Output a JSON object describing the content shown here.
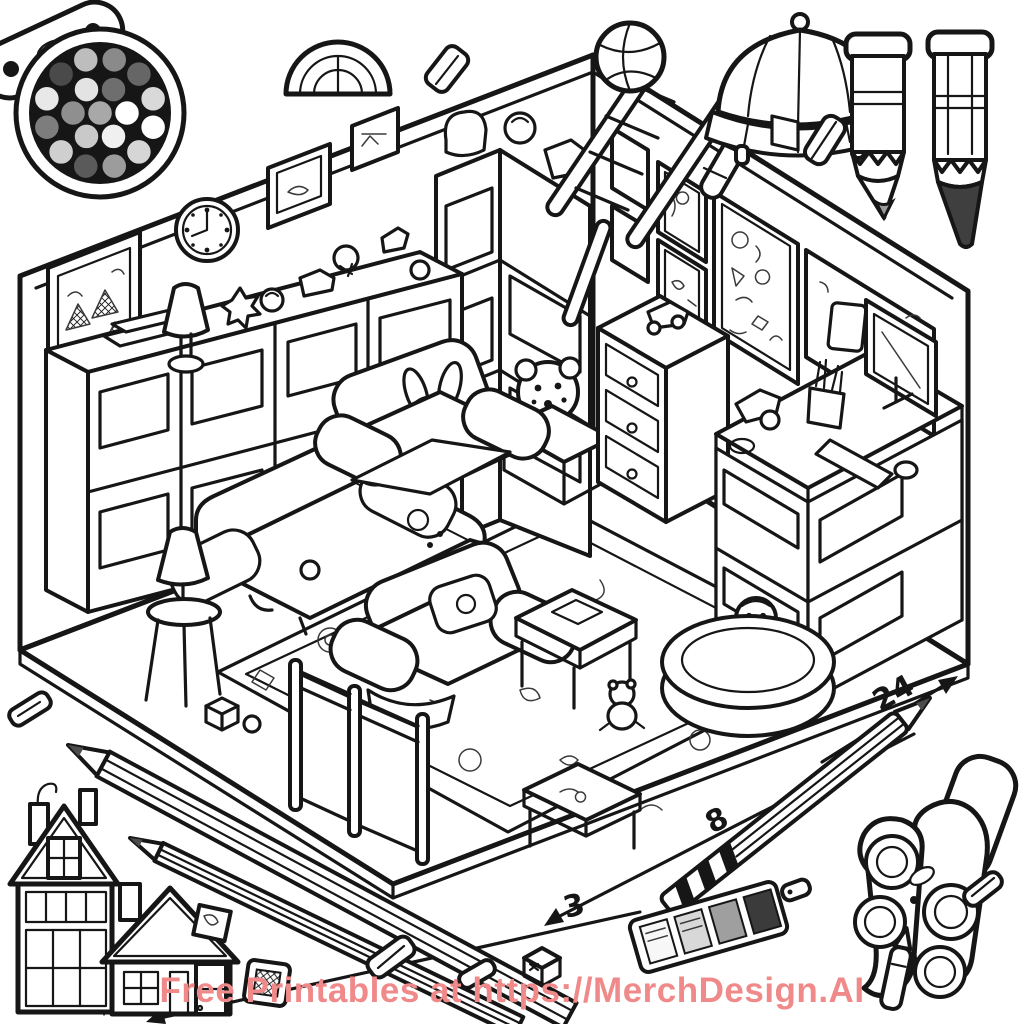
{
  "artwork": {
    "title": "Isometric playroom coloring page",
    "ink_color": "#161616",
    "background_color": "#ffffff"
  },
  "watermark": {
    "text": "Free Printables at https://MerchDesign.AI",
    "color": "#f08a8a"
  },
  "dimension_labels": {
    "long": "24",
    "mid": "8",
    "short": "3"
  },
  "palette": {
    "tray_color": "#161616",
    "well_colors": [
      "#a8a8a8",
      "#ffffff",
      "#f0f0f0",
      "#c9c9c9",
      "#8f8f8f",
      "#e3e3e3",
      "#6e6e6e",
      "#ffffff",
      "#d6d6d6",
      "#9c9c9c",
      "#5a5a5a",
      "#cfcfcf",
      "#7d7d7d",
      "#e8e8e8",
      "#4a4a4a",
      "#bdbdbd",
      "#8a8a8a",
      "#666666",
      "#d9d9d9"
    ]
  },
  "swatch_strip": {
    "cell_colors": [
      "#f7f7f7",
      "#d8d8d8",
      "#9f9f9f",
      "#3b3b3b"
    ]
  },
  "crayons": {
    "left_tip_color": "#9a9a9a",
    "right_tip_color": "#3f3f3f"
  },
  "pencil": {
    "graphite_color": "#4c4c4c"
  }
}
